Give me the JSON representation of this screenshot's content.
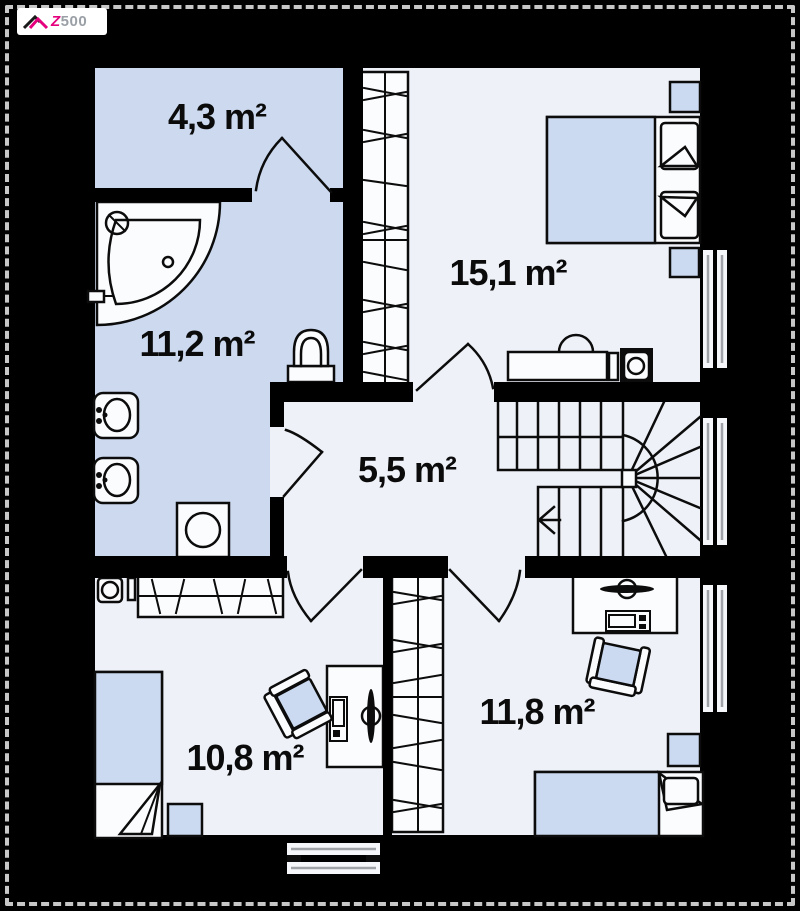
{
  "logo": {
    "brand_z": "Z",
    "brand_number": "500"
  },
  "rooms": [
    {
      "name": "top-left-room",
      "area_label": "4,3 m²"
    },
    {
      "name": "bathroom",
      "area_label": "11,2 m²"
    },
    {
      "name": "bedroom-top-right",
      "area_label": "15,1 m²"
    },
    {
      "name": "hall",
      "area_label": "5,5 m²"
    },
    {
      "name": "bedroom-bottom-left",
      "area_label": "10,8 m²"
    },
    {
      "name": "bedroom-bottom-right",
      "area_label": "11,8 m²"
    }
  ],
  "colors": {
    "background": "#000000",
    "floor_light": "#eef2f8",
    "floor_blue": "#ccd9ee",
    "furniture_blue": "#cbdaf0",
    "wall": "#000000",
    "logo_magenta": "#e5007d",
    "logo_gray": "#9aa0a6",
    "dash_border": "#c7c7c7"
  }
}
